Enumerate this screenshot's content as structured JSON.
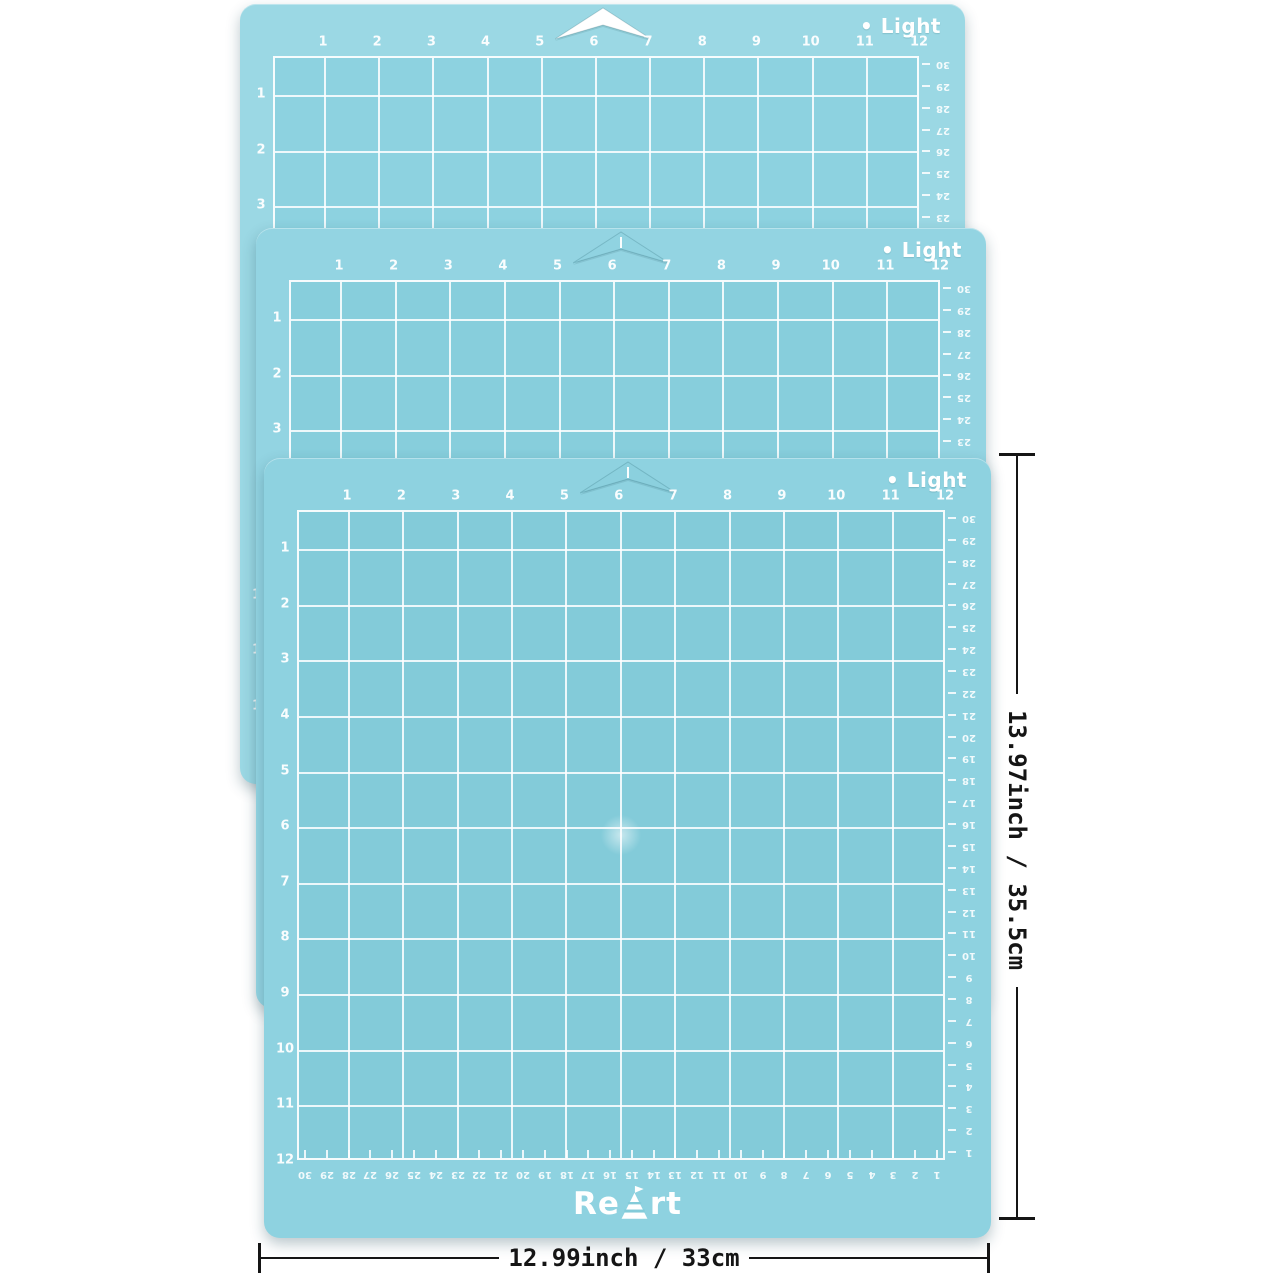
{
  "scene": {
    "background": "#ffffff"
  },
  "mat_template": {
    "variant_label": "• Light",
    "logo_text": "ReArt",
    "logo_pre": "Re",
    "logo_post": "rt",
    "inch_numbers_top": [
      1,
      2,
      3,
      4,
      5,
      6,
      7,
      8,
      9,
      10,
      11,
      12
    ],
    "inch_numbers_left": [
      1,
      2,
      3,
      4,
      5,
      6,
      7,
      8,
      9,
      10,
      11,
      12
    ],
    "cm_numbers": [
      30,
      29,
      28,
      27,
      26,
      25,
      24,
      23,
      22,
      21,
      20,
      19,
      18,
      17,
      16,
      15,
      14,
      13,
      12,
      11,
      10,
      9,
      8,
      7,
      6,
      5,
      4,
      3,
      2,
      1
    ],
    "grid_line_color": "rgba(255,255,255,0.85)",
    "label_color": "#ffffff"
  },
  "mats": [
    {
      "id": "mat-back",
      "base": "#9bd8e4",
      "inner": "#8dd2e0",
      "notch_fill": "#ffffff",
      "notch_grid_line": false
    },
    {
      "id": "mat-middle",
      "base": "#93d4e2",
      "inner": "#87cedc",
      "notch_fill": "#90d3e1",
      "notch_grid_line": true
    },
    {
      "id": "mat-front",
      "base": "#8ed2e0",
      "inner": "#83cbd9",
      "notch_fill": "#8bd0de",
      "notch_grid_line": true
    }
  ],
  "annotations": {
    "height_label": "13.97inch / 35.5cm",
    "width_label": "12.99inch / 33cm",
    "color": "#151515"
  }
}
